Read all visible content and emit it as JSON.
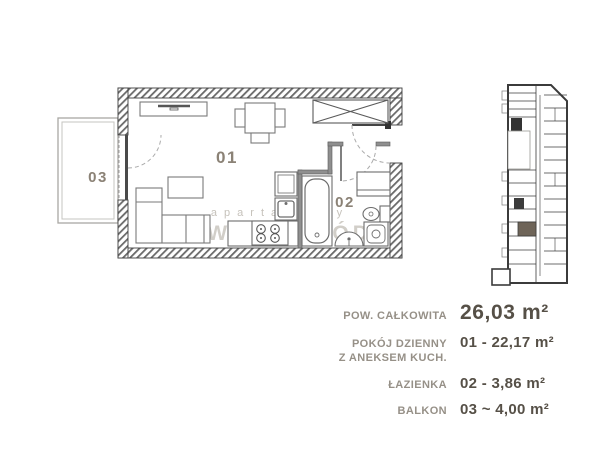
{
  "floor_plan": {
    "room_labels": {
      "living": "01",
      "bathroom": "02",
      "balcony": "03"
    }
  },
  "watermark": {
    "line1": "apartamenty",
    "line2": "WOLNA ŁÓDŹ"
  },
  "legend": {
    "total_label": "POW. CAŁKOWITA",
    "total_value": "26,03 m²",
    "rows": [
      {
        "label1": "POKÓJ DZIENNY",
        "label2": "Z ANEKSEM KUCH.",
        "value": "01 - 22,17 m²"
      },
      {
        "label1": "ŁAZIENKA",
        "label2": "",
        "value": "02 - 3,86 m²"
      },
      {
        "label1": "BALKON",
        "label2": "",
        "value": "03 ~ 4,00 m²"
      }
    ]
  },
  "colors": {
    "wall_line": "#3f3f3f",
    "furniture_line": "#777777",
    "room_label": "#8b8276",
    "legend_label": "#969087",
    "legend_value": "#565047",
    "watermark": "#c6c2bb",
    "highlight_unit": "#6e6458"
  }
}
